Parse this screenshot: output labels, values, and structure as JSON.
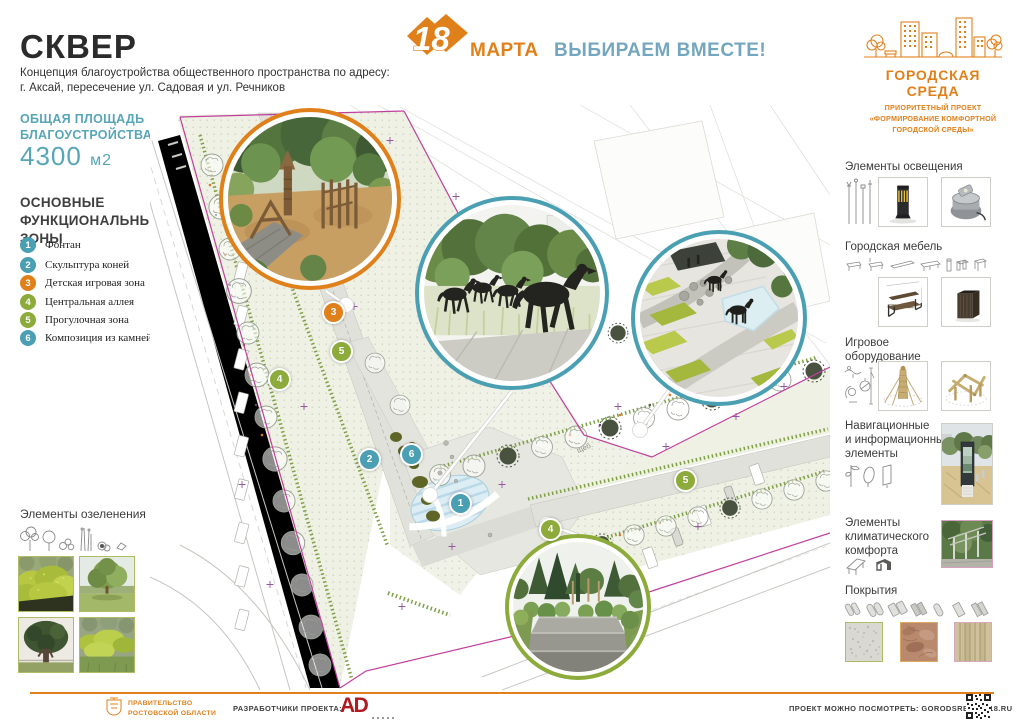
{
  "colors": {
    "orange": "#e0801b",
    "teal": "#4b9fb3",
    "green": "#8cab3a",
    "blue_slogan": "#74a7bf",
    "teal_text": "#57a6b8",
    "magenta_boundary": "#c0409d",
    "ad_red": "#b2191f"
  },
  "header": {
    "title": "СКВЕР",
    "subtitle": [
      "Концепция благоустройства общественного пространства по адресу:",
      "г. Аксай, пересечение ул. Садовая и ул. Речников"
    ],
    "campaign": {
      "date": "18",
      "month": "МАРТА",
      "slogan": "ВЫБИРАЕМ ВМЕСТЕ!"
    },
    "brand": {
      "title": "ГОРОДСКАЯ СРЕДА",
      "subtitle": [
        "ПРИОРИТЕТНЫЙ ПРОЕКТ",
        "«ФОРМИРОВАНИЕ КОМФОРТНОЙ",
        "ГОРОДСКОЙ СРЕДЫ»"
      ]
    }
  },
  "sidebar_left": {
    "area": {
      "label": [
        "ОБЩАЯ ПЛОЩАДЬ",
        "БЛАГОУСТРОЙСТВА:"
      ],
      "value": "4300",
      "unit": "м2"
    },
    "zones_title": [
      "ОСНОВНЫЕ",
      "ФУНКЦИОНАЛЬНЫЕ",
      "ЗОНЫ"
    ],
    "zones": [
      {
        "num": "1",
        "label": "Фонтан",
        "color": "#4b9fb3"
      },
      {
        "num": "2",
        "label": "Скульптура коней",
        "color": "#4b9fb3"
      },
      {
        "num": "3",
        "label": "Детская игровая зона",
        "color": "#e0801b"
      },
      {
        "num": "4",
        "label": "Центральная аллея",
        "color": "#8cab3a"
      },
      {
        "num": "5",
        "label": "Прогулочная зона",
        "color": "#8cab3a"
      },
      {
        "num": "6",
        "label": "Композиция из камней",
        "color": "#4b9fb3"
      }
    ],
    "greenery": {
      "title": "Элементы озеленения",
      "icons": [
        "cloud-tree-icon",
        "round-tree-icon",
        "shrub-icon",
        "tall-grass-icon",
        "bush-icon",
        "stone-icon"
      ],
      "photos": [
        "hedge-photo",
        "lawn-tree-photo",
        "dark-tree-photo",
        "shrub-row-photo"
      ]
    }
  },
  "sidebar_right": {
    "sections": [
      {
        "title": [
          "Элементы освещения"
        ],
        "icons": [
          "light-pole-icon"
        ],
        "photos": [
          "bollard-light-photo",
          "ground-light-photo"
        ]
      },
      {
        "title": [
          "Городская мебель"
        ],
        "icons": [
          "bench-icon",
          "beam-icon",
          "table-icon",
          "bollard-icon",
          "planter-icon",
          "bin-icon"
        ],
        "photos": [
          "bench-photo",
          "litter-bin-photo"
        ]
      },
      {
        "title": [
          "Игровое",
          "оборудование"
        ],
        "icons": [
          "spring-rider-icon",
          "carousel-icon",
          "pole-icon"
        ],
        "photos": [
          "climbing-pole-photo",
          "wooden-frame-photo"
        ]
      },
      {
        "title": [
          "Навигационные",
          "и информационные",
          "элементы"
        ],
        "icons": [
          "flag-icon",
          "oval-sign-icon",
          "panel-icon"
        ],
        "photos": [
          "info-kiosk-photo"
        ]
      },
      {
        "title": [
          "Элементы",
          "климатического",
          "комфорта"
        ],
        "icons": [
          "pergola-icon",
          "canopy-icon"
        ],
        "photos": [
          "pergola-photo"
        ]
      },
      {
        "title": [
          "Покрытия"
        ],
        "icons": [
          "paving-pattern-icons"
        ],
        "photos": [
          "granite-swatch",
          "stone-swatch",
          "wood-swatch"
        ]
      }
    ]
  },
  "plan": {
    "note": "щеб.",
    "markers": [
      {
        "num": "3",
        "color": "#e0801b"
      },
      {
        "num": "5",
        "color": "#8cab3a"
      },
      {
        "num": "4",
        "color": "#8cab3a"
      },
      {
        "num": "2",
        "color": "#4b9fb3"
      },
      {
        "num": "6",
        "color": "#4b9fb3"
      },
      {
        "num": "1",
        "color": "#4b9fb3"
      },
      {
        "num": "5",
        "color": "#8cab3a"
      },
      {
        "num": "4",
        "color": "#8cab3a"
      }
    ],
    "insets": [
      "playground-render",
      "horse-sculptures-render",
      "plaza-render",
      "walkway-render"
    ]
  },
  "footer": {
    "government": [
      "ПРАВИТЕЛЬСТВО",
      "РОСТОВСКОЙ ОБЛАСТИ"
    ],
    "developers_label": "РАЗРАБОТЧИКИ ПРОЕКТА:",
    "developer_logo": "AD",
    "view_label": "ПРОЕКТ МОЖНО ПОСМОТРЕТЬ: GORODSREDA2018.RU"
  }
}
